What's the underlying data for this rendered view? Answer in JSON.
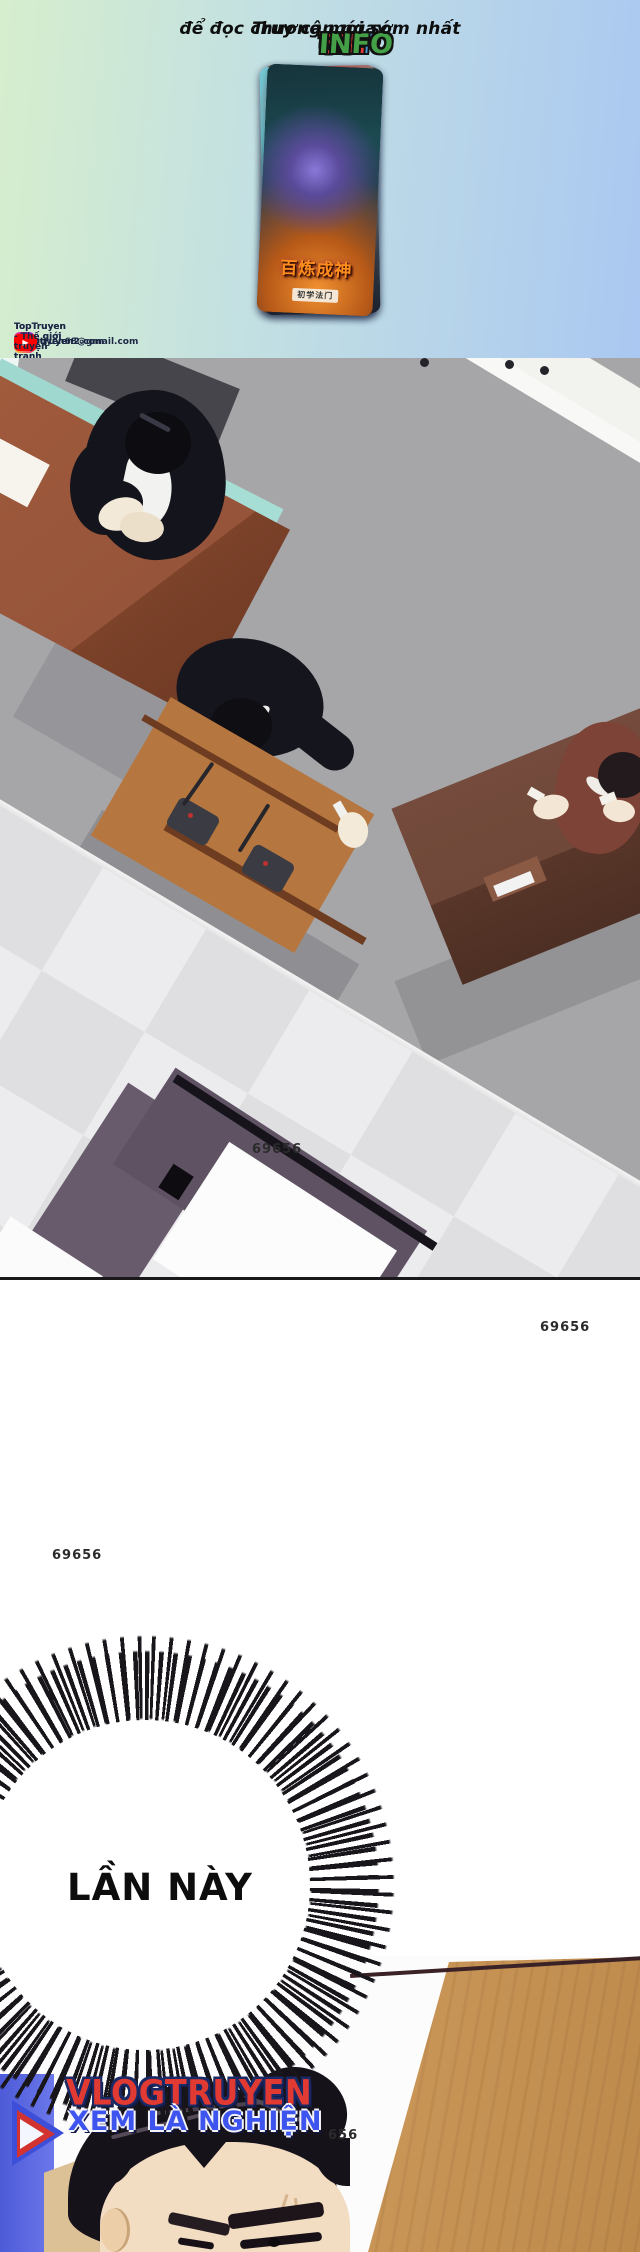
{
  "promo_bar": {
    "prefix": "Truy cập ngay",
    "suffix": "để đọc chương mới sớm nhất",
    "logo_segments": [
      {
        "text": "TOP",
        "color": "#4a9ad8"
      },
      {
        "text": "TR",
        "color": "#f08c28"
      },
      {
        "text": "U",
        "color": "#4a9ad8"
      },
      {
        "text": "Y",
        "color": "#f5c926"
      },
      {
        "text": "E",
        "color": "#5292d0"
      },
      {
        "text": "N",
        "color": "#8bc34a"
      },
      {
        "text": "68.",
        "color": "#e23b34"
      },
      {
        "text": "INFO",
        "color": "#43a047"
      }
    ]
  },
  "covers": [
    {
      "title_top": "THE",
      "title": "DEVIL BUTLER"
    },
    {
      "title": "武炼巅峰"
    },
    {
      "title": ""
    },
    {
      "title": "开局一座山"
    },
    {
      "title": "百炼成神",
      "badge": "初学法门"
    }
  ],
  "socials": [
    {
      "platform": "facebook",
      "glyph": "f",
      "label": "TopTruyen - Thế giới truyện tranh"
    },
    {
      "platform": "gmail",
      "glyph": "M",
      "label": "toptruyen68@gmail.com"
    },
    {
      "platform": "tiktok",
      "glyph": "♪",
      "label": "@toptruyen2.com"
    },
    {
      "platform": "instagram",
      "glyph": "",
      "label": "@toptruyen"
    },
    {
      "platform": "youtube",
      "glyph": "▶",
      "label": "TopTruyen - Thế giới truyện tranh"
    }
  ],
  "scene": {
    "wall_sign": "W/EO",
    "page_number": "69656"
  },
  "page_numbers": {
    "second": "69656",
    "third": "69656",
    "partial": "656"
  },
  "speech_bubble": {
    "text": "LẦN NÀY"
  },
  "watermark": {
    "title": "VLOGTRUYEN",
    "tagline": "XEM LÀ NGHIỆN"
  },
  "colors": {
    "banner_left": "#d6eecd",
    "banner_right": "#aac8f1",
    "floor_gray": "#a6a6a8",
    "checker_light": "#ececee",
    "checker_dark": "#dfdfe2",
    "podium_wood": "#b5773f",
    "teal_bench": "#9fd8cf",
    "desk_brown": "#9a573b",
    "desk_dark_brown": "#6f4839",
    "desk_purple": "#5e5263",
    "suit_black": "#15151d",
    "shirt_maroon": "#7c4336",
    "wall_wood": "#cd9a5c",
    "wall_blue": "#5b66e0",
    "logo_red": "#e13a32",
    "logo_blue": "#3d55ee"
  }
}
